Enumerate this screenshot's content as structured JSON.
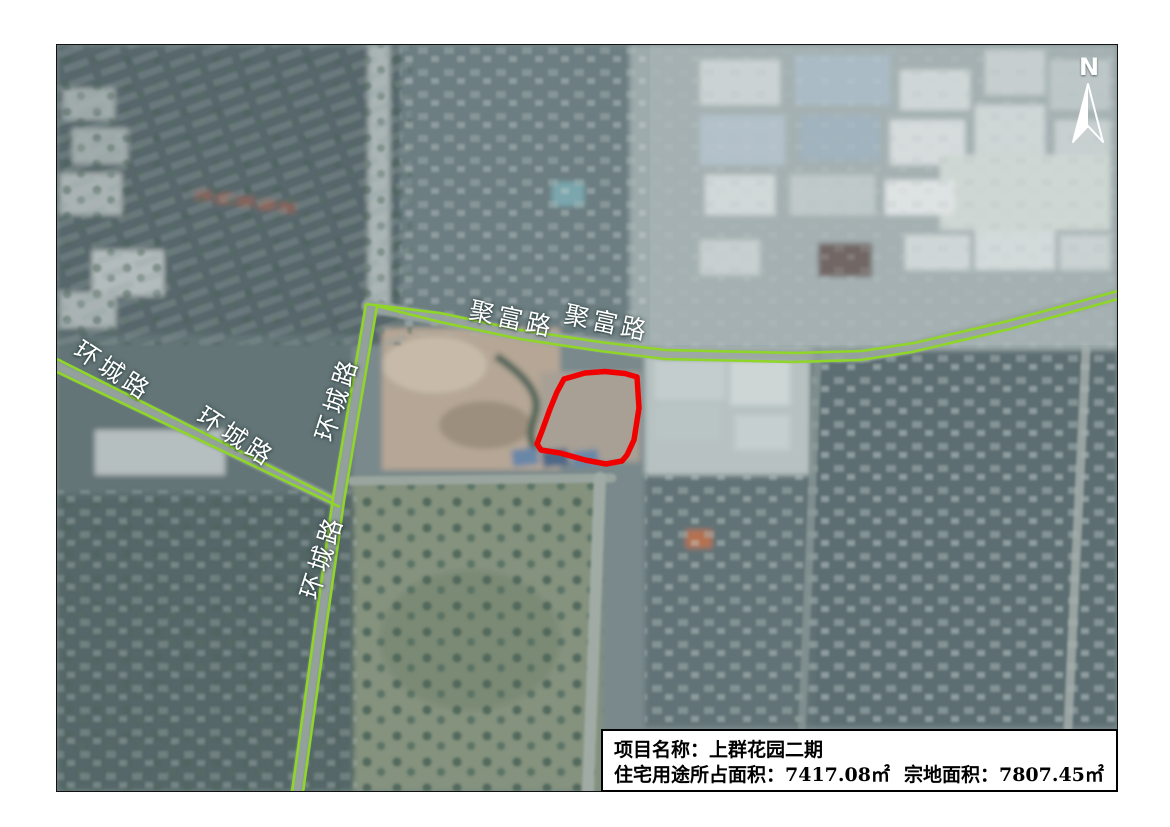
{
  "map": {
    "north": {
      "label": "N"
    },
    "road_labels": [
      {
        "text": "环城路"
      },
      {
        "text": "环城路"
      },
      {
        "text": "环城路"
      },
      {
        "text": "环城路"
      },
      {
        "text": "聚富路"
      },
      {
        "text": "聚富路"
      }
    ],
    "parcel_outline_color": "#f10000",
    "road_line_color": "#8fd628"
  },
  "info_box": {
    "project_label": "项目名称：",
    "project_name": "上群花园二期",
    "residential_label": "住宅用途所占面积：",
    "residential_value": "7417.08㎡",
    "parcel_label": "宗地面积：",
    "parcel_value": "7807.45㎡"
  }
}
